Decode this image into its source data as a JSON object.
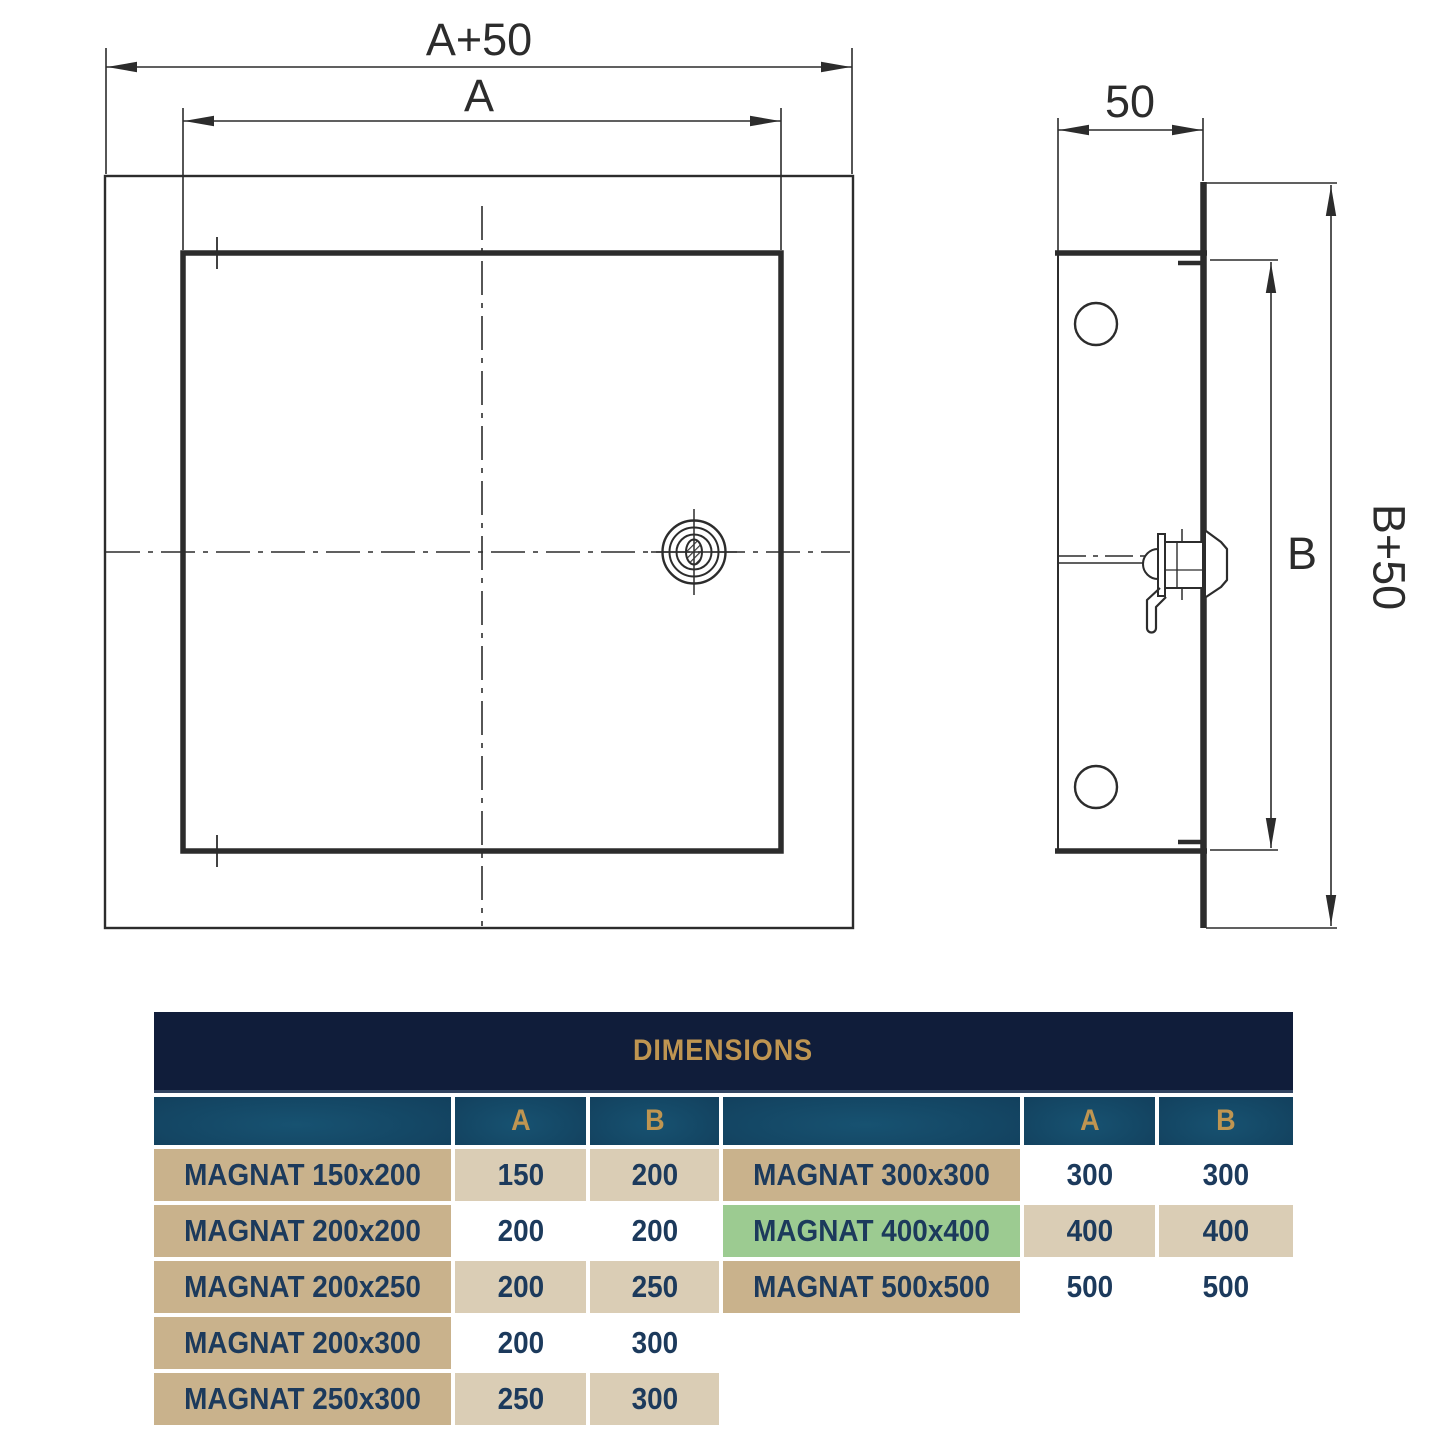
{
  "drawing": {
    "labels": {
      "front_width_outer": "A+50",
      "front_width_inner": "A",
      "side_depth": "50",
      "side_height_inner": "B",
      "side_height_outer": "B+50"
    }
  },
  "table": {
    "title": "DIMENSIONS",
    "columns": {
      "name": "",
      "a": "A",
      "b": "B"
    },
    "left_rows": [
      {
        "name": "MAGNAT 150x200",
        "a": "150",
        "b": "200"
      },
      {
        "name": "MAGNAT 200x200",
        "a": "200",
        "b": "200"
      },
      {
        "name": "MAGNAT 200x250",
        "a": "200",
        "b": "250"
      },
      {
        "name": "MAGNAT 200x300",
        "a": "200",
        "b": "300"
      },
      {
        "name": "MAGNAT 250x300",
        "a": "250",
        "b": "300"
      }
    ],
    "right_rows": [
      {
        "name": "MAGNAT 300x300",
        "a": "300",
        "b": "300",
        "highlighted": false
      },
      {
        "name": "MAGNAT 400x400",
        "a": "400",
        "b": "400",
        "highlighted": true
      },
      {
        "name": "MAGNAT 500x500",
        "a": "500",
        "b": "500",
        "highlighted": false
      }
    ]
  },
  "colors": {
    "header_navy": "#101d3a",
    "header_gold": "#bf9551",
    "subheader_teal_dark": "#0d3049",
    "subheader_teal_light": "#175271",
    "row_name_tan": "#c9b28c",
    "row_value_tan": "#dacdb5",
    "row_value_white": "#ffffff",
    "highlight_green": "#9ccb91",
    "table_text_navy": "#1c3a5c",
    "drawing_line": "#2c2c2c"
  }
}
